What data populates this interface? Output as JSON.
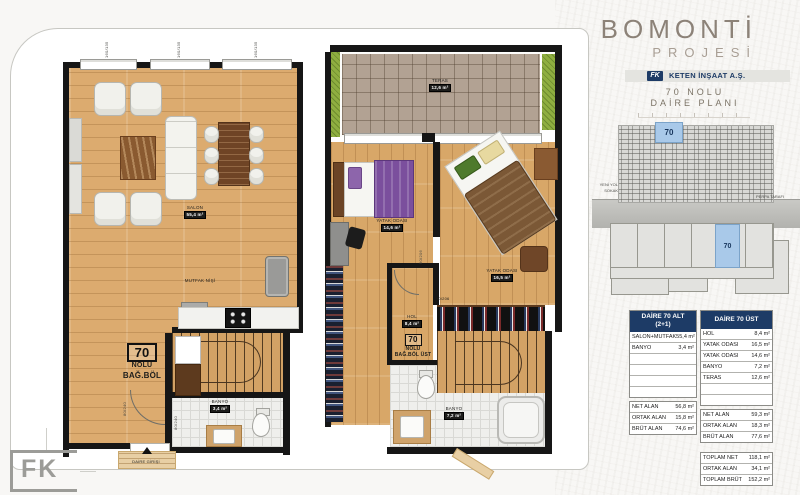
{
  "header": {
    "title": "BOMONTİ",
    "subtitle": "PROJESİ",
    "logo_text": "FK",
    "company": "KETEN İNŞAAT A.Ş.",
    "plan_no_line1": "70 NOLU",
    "plan_no_line2": "DAİRE PLANI"
  },
  "elevation": {
    "unit": "70",
    "left_label_line1": "YENİ YOL",
    "left_label_line2": "SOKAK",
    "right_label": "PERPA TARAFI"
  },
  "siteplan": {
    "unit": "70"
  },
  "tables": {
    "alt": {
      "header_line1": "DAİRE 70 ALT",
      "header_line2": "(2+1)",
      "rooms": [
        [
          "SALON+MUTFAK",
          "55,4 m²"
        ],
        [
          "BANYO",
          "3,4 m²"
        ],
        [
          "",
          ""
        ],
        [
          "",
          ""
        ],
        [
          "",
          ""
        ],
        [
          "",
          ""
        ]
      ],
      "areas": [
        [
          "NET ALAN",
          "56,8 m²"
        ],
        [
          "ORTAK ALAN",
          "15,8 m²"
        ],
        [
          "BRÜT ALAN",
          "74,6 m²"
        ]
      ]
    },
    "ust": {
      "header_line1": "DAİRE 70 ÜST",
      "rooms": [
        [
          "HOL",
          "8,4 m²"
        ],
        [
          "YATAK ODASI",
          "16,5 m²"
        ],
        [
          "YATAK ODASI",
          "14,6 m²"
        ],
        [
          "BANYO",
          "7,2 m²"
        ],
        [
          "TERAS",
          "12,6 m²"
        ],
        [
          "",
          ""
        ],
        [
          "",
          ""
        ]
      ],
      "areas": [
        [
          "NET ALAN",
          "59,3 m²"
        ],
        [
          "ORTAK ALAN",
          "18,3 m²"
        ],
        [
          "BRÜT ALAN",
          "77,6 m²"
        ]
      ],
      "totals": [
        [
          "TOPLAM NET",
          "118,1 m²"
        ],
        [
          "ORTAK ALAN",
          "34,1 m²"
        ],
        [
          "TOPLAM BRÜT",
          "152,2 m²"
        ]
      ]
    }
  },
  "plan_lower": {
    "salon_label": "SALON",
    "salon_area": "55,4 m²",
    "mutfak_label": "MUTFAK NİŞİ",
    "unit_no": "70",
    "unit_line1": "NOLU",
    "unit_line2": "BAĞ.BÖL",
    "banyo_label": "BANYO",
    "banyo_area": "3,4 m²",
    "entrance_label": "DAİRE GİRİŞİ",
    "door_tag": "80/240",
    "window_tags": [
      "160/135",
      "160/135",
      "160/135"
    ]
  },
  "plan_upper": {
    "teras_label": "TERAS",
    "teras_area": "12,6 m²",
    "bed1_label": "YATAK ODASI",
    "bed1_area": "14,6 m²",
    "bed2_label": "YATAK ODASI",
    "bed2_area": "16,5 m²",
    "hol_label": "HOL",
    "hol_area": "8,4 m²",
    "unit_no": "70",
    "unit_line1": "NOLU",
    "unit_line2": "BAĞ.BÖL ÜST",
    "banyo_label": "BANYO",
    "banyo_area": "7,2 m²",
    "door_tag": "90/206"
  },
  "footer": {
    "logo": "FK"
  }
}
